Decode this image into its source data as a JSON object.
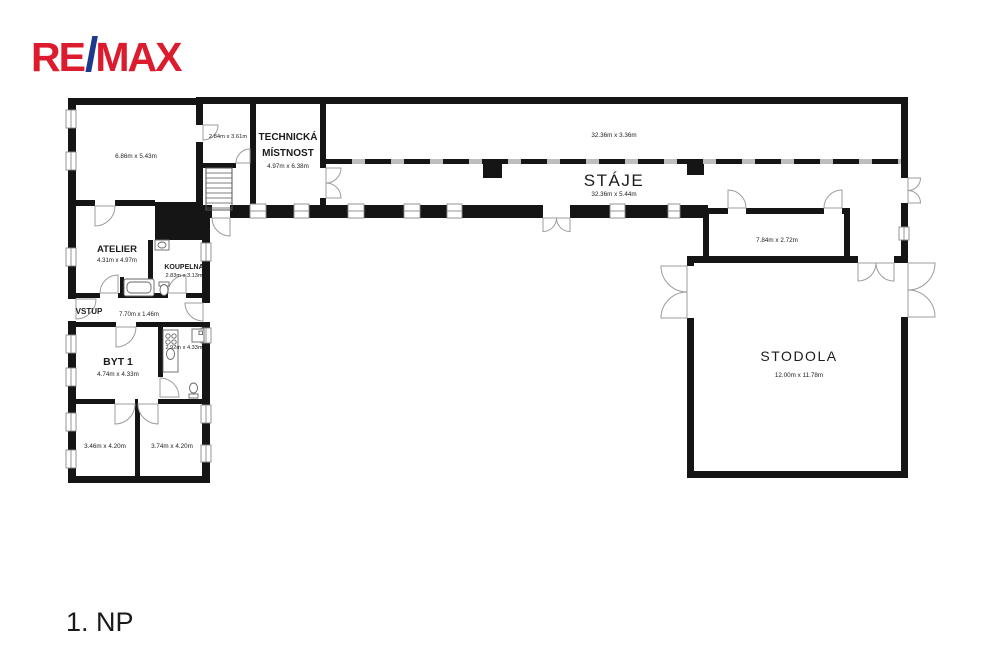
{
  "brand": {
    "re": "RE",
    "slash": "/",
    "max": "MAX",
    "red": "#DC1C2E",
    "blue": "#1E3A8C"
  },
  "floor_label": "1. NP",
  "rooms": {
    "room_686": {
      "dims": "6.86m x 5.43m"
    },
    "atelier": {
      "name": "ATELIER",
      "dims": "4.31m x 4.97m"
    },
    "koupelna": {
      "name": "KOUPELNA",
      "dims": "2.83m x 3.13m"
    },
    "vstup": {
      "name": "VSTUP",
      "dims": "7.70m x 1.46m"
    },
    "byt1": {
      "name": "BYT 1",
      "dims": "4.74m x 4.33m"
    },
    "kitchen": {
      "dims": "2.92m x 4.33m"
    },
    "room_346": {
      "dims": "3.46m x 4.20m"
    },
    "room_374": {
      "dims": "3.74m x 4.20m"
    },
    "room_284": {
      "dims": "2.84m x 3.61m"
    },
    "technicka": {
      "name_line1": "TECHNICKÁ",
      "name_line2": "MÍSTNOST",
      "dims": "4.97m x 6.38m"
    },
    "strip": {
      "dims": "32.36m x 3.36m"
    },
    "staje": {
      "name": "STÁJE",
      "dims": "32.36m x 5.44m"
    },
    "room_784": {
      "dims": "7.84m x 2.72m"
    },
    "stodola": {
      "name": "STODOLA",
      "dims": "12.00m x 11.78m"
    }
  }
}
